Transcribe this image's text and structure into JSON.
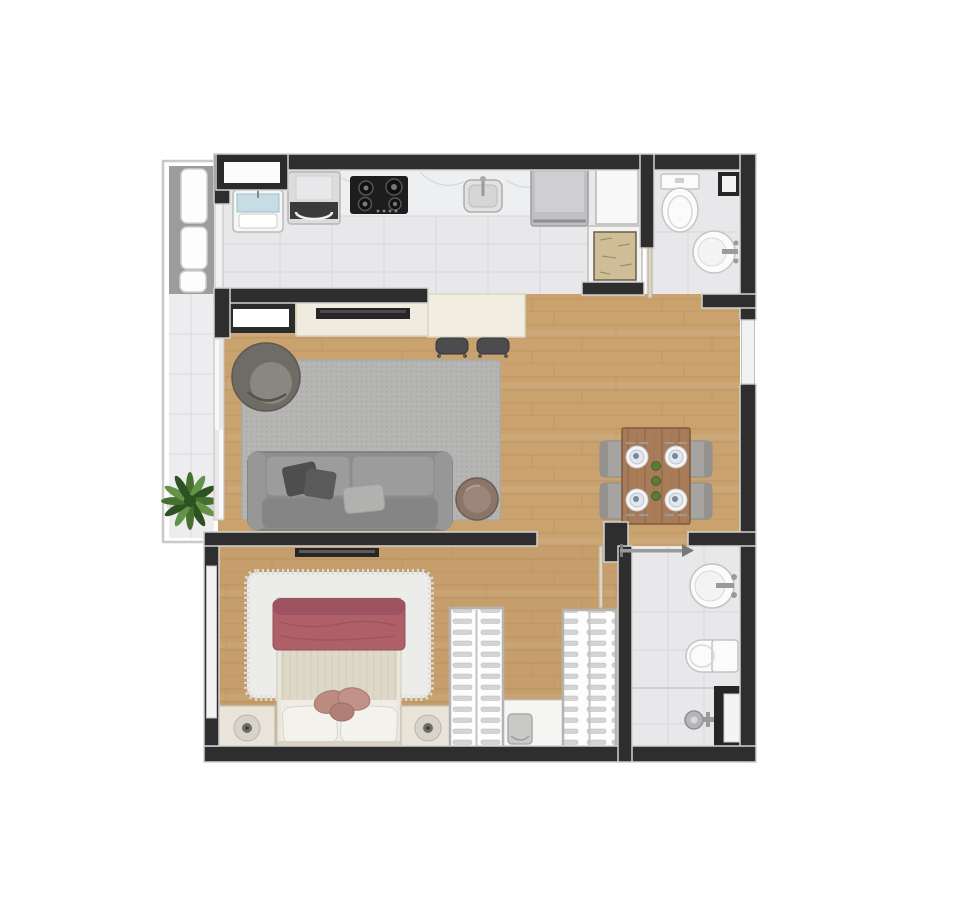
{
  "meta": {
    "kind": "apartment-floor-plan-render",
    "view": "top-down",
    "canvas_width": 972,
    "canvas_height": 900
  },
  "colors": {
    "wall": "#2e2e2e",
    "wall_edge": "#d2d2d2",
    "glass": "#f2f2f2",
    "wood": "#c9a26e",
    "wood_line": "#b2875a",
    "tile": "#e8e8ea",
    "tile_line": "#d9d9dc",
    "balcony_deck": "#9c9c9e",
    "terrace": "#ededef",
    "shutter": "#fdfdfd",
    "rug": "#b4b4b2",
    "rug_dot": "#a7a7a5",
    "fluffy_rug": "#ececea",
    "sofa": "#8e8e8e",
    "sofa_cushion": "#9c9c9c",
    "sofa_back": "#858585",
    "pillow_dark": "#4e4e4e",
    "pillow_light": "#b1b1af",
    "armchair": "#6f6c66",
    "armchair_seat": "#8a8680",
    "side_table": "#8b7569",
    "console": "#f0ebdf",
    "counter": "#f2ede1",
    "tv": "#262626",
    "stool": "#4c4c4e",
    "marble": "#edeff1",
    "marble_vein": "#ccd0d5",
    "stove": "#1d1d1d",
    "appliance": "#dcdcde",
    "fridge": "#c0c0c2",
    "cabinet": "#f8f8f8",
    "duct": "#cfbd98",
    "laundry_blue": "#c6dde6",
    "fixture": "#fbfbfb",
    "fixture_edge": "#c4c4c4",
    "niche": "#262626",
    "table_wood": "#a87c58",
    "table_line": "#8f6746",
    "chair": "#a5a4a0",
    "plate": "#f5f5f7",
    "plate_food": "#7787a0",
    "decor_green": "#5d7a36",
    "blanket": "#ae5f68",
    "blanket_roll": "#9d5360",
    "sheet": "#ded8c8",
    "bed_white": "#efece6",
    "pillow": "#f4f2ed",
    "cushion": "#bd8b82",
    "nightstand": "#e9e4da",
    "lamp": "#d9d4c9",
    "lamp_center": "#6e6e68",
    "wardrobe": "#fdfdfd",
    "hanger": "#d4d4d2",
    "bench": "#c9c9c7",
    "plant_dark": "#2e5122",
    "plant_mid": "#46702f",
    "plant_light": "#629346",
    "door_leaf": "#dfd5c5",
    "slider": "#9a9a9a"
  },
  "rooms": [
    {
      "id": "balcony",
      "features": [
        "louver-shutters",
        "terrace-tiles",
        "potted-plant"
      ]
    },
    {
      "id": "kitchen",
      "features": [
        "laundry-tub",
        "washing-machine",
        "cooktop",
        "marble-countertop",
        "kitchen-sink",
        "refrigerator",
        "tall-cabinet",
        "service-duct",
        "window"
      ]
    },
    {
      "id": "bathroom-top",
      "features": [
        "toilet",
        "round-washbasin",
        "wall-niche",
        "swing-door"
      ]
    },
    {
      "id": "living-room",
      "features": [
        "framed-low-cabinet",
        "media-console",
        "tv",
        "bar-counter",
        "bar-stools",
        "area-rug",
        "round-armchair",
        "sofa",
        "throw-pillows",
        "side-table",
        "balcony-sliding-door",
        "window-right"
      ]
    },
    {
      "id": "dining-area",
      "features": [
        "wood-table",
        "chairs-x4",
        "place-settings-x4",
        "green-centerpiece"
      ]
    },
    {
      "id": "bedroom",
      "features": [
        "double-bed",
        "rose-blanket",
        "pillows",
        "fluffy-rug",
        "nightstand-left",
        "nightstand-right",
        "lamps",
        "tv",
        "window-left",
        "door"
      ]
    },
    {
      "id": "closet",
      "features": [
        "wardrobe-left-hangers",
        "wardrobe-right-hangers",
        "shelf-unit",
        "ottoman"
      ]
    },
    {
      "id": "bathroom-bottom",
      "features": [
        "round-washbasin",
        "toilet",
        "shower-valve",
        "glass-niche",
        "sliding-door"
      ]
    }
  ]
}
